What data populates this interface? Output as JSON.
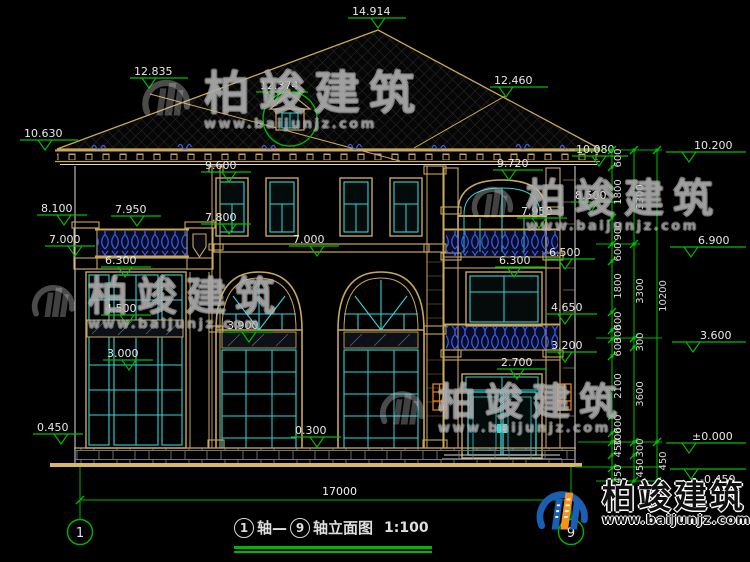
{
  "drawing": {
    "title": {
      "axis_from": "1",
      "separator": "轴—",
      "axis_to": "9",
      "suffix": "轴立面图",
      "scale": "1:100"
    },
    "axis_bubbles": [
      {
        "label": "1",
        "x": 80,
        "y": 532
      },
      {
        "label": "9",
        "x": 571,
        "y": 532
      }
    ],
    "ground_dimension": {
      "value": "17000",
      "x": 322,
      "y": 495
    },
    "elevation_markers": [
      {
        "v": "14.914",
        "tx": 352,
        "ty": 5,
        "lx": 348,
        "ly": 18,
        "ll": 58,
        "cx": 378
      },
      {
        "v": "12.835",
        "tx": 134,
        "ty": 65,
        "lx": 130,
        "ly": 78,
        "ll": 58,
        "cx": 149
      },
      {
        "v": "12.374",
        "tx": 260,
        "ty": 79,
        "lx": 256,
        "ly": 92,
        "ll": 52,
        "cx": 274
      },
      {
        "v": "12.460",
        "tx": 494,
        "ty": 74,
        "lx": 490,
        "ly": 87,
        "ll": 58,
        "cx": 506
      },
      {
        "v": "10.630",
        "tx": 24,
        "ty": 127,
        "lx": 20,
        "ly": 140,
        "ll": 58,
        "cx": 45
      },
      {
        "v": "10.080",
        "tx": 576,
        "ty": 143,
        "lx": 572,
        "ly": 156,
        "ll": 56,
        "cx": 599
      },
      {
        "v": "9.600",
        "tx": 205,
        "ty": 159,
        "lx": 201,
        "ly": 172,
        "ll": 50,
        "cx": 229
      },
      {
        "v": "9.720",
        "tx": 497,
        "ty": 157,
        "lx": 493,
        "ly": 170,
        "ll": 50,
        "cx": 509
      },
      {
        "v": "8.100",
        "tx": 41,
        "ty": 202,
        "lx": 37,
        "ly": 215,
        "ll": 50,
        "cx": 64
      },
      {
        "v": "7.950",
        "tx": 115,
        "ty": 203,
        "lx": 111,
        "ly": 216,
        "ll": 50,
        "cx": 137
      },
      {
        "v": "8.500",
        "tx": 575,
        "ty": 189,
        "lx": 571,
        "ly": 202,
        "ll": 50,
        "cx": 591
      },
      {
        "v": "7.950",
        "tx": 521,
        "ty": 205,
        "lx": 517,
        "ly": 218,
        "ll": 50,
        "cx": 539
      },
      {
        "v": "7.800",
        "tx": 205,
        "ty": 211,
        "lx": 201,
        "ly": 224,
        "ll": 50,
        "cx": 229
      },
      {
        "v": "7.000",
        "tx": 49,
        "ty": 233,
        "lx": 45,
        "ly": 246,
        "ll": 50,
        "cx": 75
      },
      {
        "v": "7.000",
        "tx": 293,
        "ty": 233,
        "lx": 289,
        "ly": 246,
        "ll": 50,
        "cx": 317
      },
      {
        "v": "6.300",
        "tx": 105,
        "ty": 254,
        "lx": 101,
        "ly": 267,
        "ll": 50,
        "cx": 125
      },
      {
        "v": "6.300",
        "tx": 499,
        "ty": 254,
        "lx": 495,
        "ly": 267,
        "ll": 50,
        "cx": 514
      },
      {
        "v": "6.500",
        "tx": 549,
        "ty": 246,
        "lx": 545,
        "ly": 259,
        "ll": 50,
        "cx": 565
      },
      {
        "v": "4.500",
        "tx": 105,
        "ty": 302,
        "lx": 101,
        "ly": 315,
        "ll": 50,
        "cx": 127
      },
      {
        "v": "4.650",
        "tx": 551,
        "ty": 301,
        "lx": 547,
        "ly": 314,
        "ll": 50,
        "cx": 565
      },
      {
        "v": "3.900",
        "tx": 227,
        "ty": 319,
        "lx": 223,
        "ly": 332,
        "ll": 50,
        "cx": 249
      },
      {
        "v": "3.200",
        "tx": 551,
        "ty": 339,
        "lx": 547,
        "ly": 352,
        "ll": 50,
        "cx": 565
      },
      {
        "v": "3.000",
        "tx": 107,
        "ty": 347,
        "lx": 103,
        "ly": 360,
        "ll": 50,
        "cx": 129
      },
      {
        "v": "2.700",
        "tx": 501,
        "ty": 356,
        "lx": 497,
        "ly": 369,
        "ll": 50,
        "cx": 517
      },
      {
        "v": "0.450",
        "tx": 37,
        "ty": 421,
        "lx": 33,
        "ly": 434,
        "ll": 50,
        "cx": 61
      },
      {
        "v": "0.300",
        "tx": 295,
        "ty": 424,
        "lx": 291,
        "ly": 437,
        "ll": 50,
        "cx": 317
      },
      {
        "v": "10.200",
        "tx": 694,
        "ty": 139,
        "lx": 666,
        "ly": 152,
        "ll": 80,
        "cx": 689
      },
      {
        "v": "6.900",
        "tx": 698,
        "ty": 234,
        "lx": 670,
        "ly": 247,
        "ll": 76,
        "cx": 691
      },
      {
        "v": "3.600",
        "tx": 700,
        "ty": 329,
        "lx": 672,
        "ly": 342,
        "ll": 74,
        "cx": 693
      },
      {
        "v": "±0.000",
        "tx": 692,
        "ty": 430,
        "lx": 666,
        "ly": 443,
        "ll": 80,
        "cx": 689
      },
      {
        "v": "-0.450",
        "tx": 700,
        "ty": 473,
        "lx": 670,
        "ly": 469,
        "ll": 76,
        "cx": 691
      }
    ],
    "dim_chains": [
      {
        "name": "segments",
        "x": 612,
        "label_x": 621,
        "y1": 150,
        "y2": 481,
        "ticks": [
          150,
          167,
          218,
          244,
          261,
          312,
          330,
          339,
          356,
          416,
          433,
          442,
          455,
          468,
          481
        ],
        "labels": [
          {
            "v": "600",
            "y": 158
          },
          {
            "v": "1800",
            "y": 192
          },
          {
            "v": "900",
            "y": 231
          },
          {
            "v": "600",
            "y": 252
          },
          {
            "v": "1800",
            "y": 286
          },
          {
            "v": "600",
            "y": 321
          },
          {
            "v": "300",
            "y": 334
          },
          {
            "v": "600",
            "y": 347
          },
          {
            "v": "2100",
            "y": 386
          },
          {
            "v": "600",
            "y": 424
          },
          {
            "v": "300",
            "y": 437
          },
          {
            "v": "450",
            "y": 448
          },
          {
            "v": "450",
            "y": 474
          }
        ]
      },
      {
        "name": "floors",
        "x": 634,
        "label_x": 643,
        "y1": 150,
        "y2": 481,
        "ticks": [
          150,
          244,
          338,
          347,
          442,
          455,
          481
        ],
        "labels": [
          {
            "v": "3300",
            "y": 197
          },
          {
            "v": "3300",
            "y": 291
          },
          {
            "v": "300",
            "y": 342
          },
          {
            "v": "3600",
            "y": 394
          },
          {
            "v": "300",
            "y": 448
          },
          {
            "v": "450",
            "y": 468
          }
        ]
      },
      {
        "name": "total",
        "x": 657,
        "label_x": 666,
        "y1": 150,
        "y2": 481,
        "ticks": [
          150,
          442,
          481
        ],
        "labels": [
          {
            "v": "10200",
            "y": 296
          },
          {
            "v": "450",
            "y": 461
          }
        ]
      }
    ]
  },
  "watermarks": {
    "brand": "柏竣建筑",
    "site": "www.baijunjz.com"
  },
  "colors": {
    "background": "#000000",
    "dimension_green": "#00B400",
    "frame_tan": "#C9A85C",
    "window_cyan": "#2FD8D8",
    "railing_blue": "#3C5BE8",
    "lamp_orange": "#E87E1A",
    "wall_white": "#D8D8D8",
    "logo_blue": "#1B5FB5",
    "logo_orange": "#F6921E"
  }
}
